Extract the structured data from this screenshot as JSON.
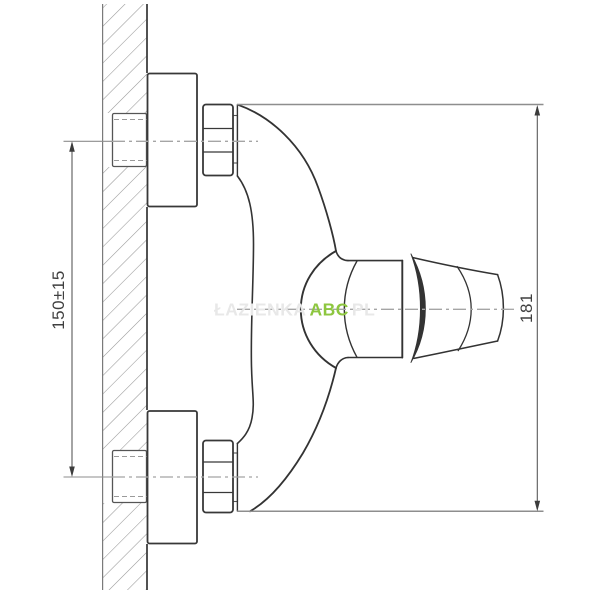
{
  "drawing": {
    "dimensions": {
      "mounting": {
        "label": "150±15"
      },
      "height": {
        "label": "181"
      }
    },
    "watermark": {
      "prefix": "ŁAZIENKA",
      "brand": "ABC",
      "suffix": "PL"
    },
    "colors": {
      "outline": "#333333",
      "dimension_line": "#5a5a5a",
      "extension_line": "#8e8e8e",
      "hatch": "#979797",
      "centerline": "#a5a5a5",
      "watermark_brand": "#8dc63f",
      "watermark_faint": "#e8e8e8",
      "label_text": "#3f3f3f"
    }
  }
}
